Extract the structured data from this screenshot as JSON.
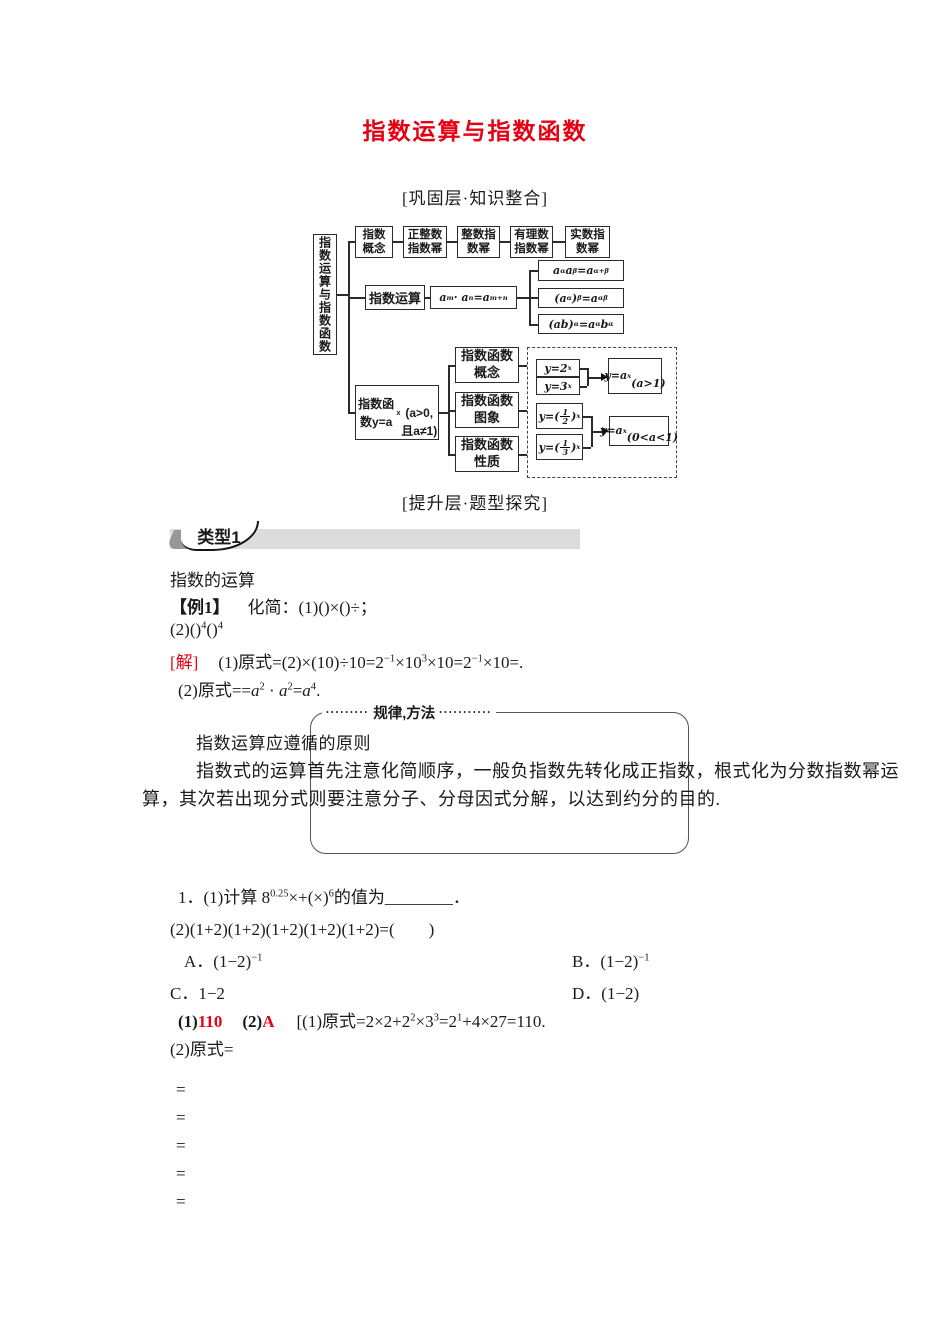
{
  "title": "指数运算与指数函数",
  "sections": {
    "consolidate": "[巩固层·知识整合]",
    "improve": "[提升层·题型探究]"
  },
  "diagram": {
    "root": "指数运算与指数函数",
    "concept_chain": [
      "指数<br>概念",
      "正整数<br>指数幂",
      "整数指<br>数幂",
      "有理数<br>指数幂",
      "实数指<br>数幂"
    ],
    "operation": {
      "label": "指数运算",
      "formula": "a<sup>m</sup> · a<sup>n</sup>=a<sup>m+n</sup>",
      "rules": [
        "a<sup>α</sup>a<sup>β</sup>=a<sup>α+β</sup>",
        "(a<sup>α</sup>)<sup>β</sup>=a<sup>αβ</sup>",
        "(ab)<sup>α</sup>=a<sup>α</sup>b<sup>α</sup>"
      ]
    },
    "function": {
      "label": "指数函数y=a<sup>x</sup><br>(a&gt;0,且a≠1)",
      "children": [
        "指数函数<br>概念",
        "指数函数<br>图象",
        "指数函数<br>性质"
      ],
      "examples_gt1": [
        "y=2<sup>x</sup>",
        "y=3<sup>x</sup>"
      ],
      "result_gt1": "y=a<sup>x</sup><br>(a&gt;1)",
      "examples_lt1": [
        "y=(<span class=fr><i>1</i><i>2</i></span>)<sup>x</sup>",
        "y=(<span class=fr><i>1</i><i>3</i></span>)<sup>x</sup>"
      ],
      "result_lt1": "y=a<sup>x</sup><br>(0&lt;a&lt;1)"
    }
  },
  "type1": {
    "badge": "类型1",
    "subtitle": "指数的运算"
  },
  "example1": {
    "label": "【例1】",
    "intro": "化简：(1)()×()÷；",
    "line2": "(2)()<sup>4</sup>()<sup>4</sup>",
    "solution_label": "[解]",
    "solution1": "(1)原式=(2)×(10)÷10=2<sup>−1</sup>×10<sup>3</sup>×10=2<sup>−1</sup>×10=.",
    "solution2": "(2)原式==<i>a</i><sup>2</sup> · <i>a</i><sup>2</sup>=<i>a</i><sup>4</sup>."
  },
  "method_box": {
    "dots_left": "•••••••••",
    "title": "规律,方法",
    "dots_right": "•••••••••••",
    "heading": "指数运算应遵循的原则",
    "body_line1": "指数式的运算首先注意化简顺序，一般负指数先转化成正指数，根式化为分数指数幂运",
    "body_line2": "算，其次若出现分式则要注意分子、分母因式分解，以达到约分的目的."
  },
  "exercise": {
    "q1": "1．(1)计算 8<sup>0.25</sup>×+(×)<sup>6</sup>的值为________．",
    "q2": "(2)(1+2)(1+2)(1+2)(1+2)(1+2)=(　　)",
    "optionA": "A．(1−2)<sup>−1</sup>",
    "optionB": "B．(1−2)<sup>−1</sup>",
    "optionC": "C．1−2",
    "optionD": "D．(1−2)",
    "answer": {
      "num1": "(1)",
      "ans1": "110",
      "num2": "(2)",
      "ans2": "A",
      "work": "[(1)原式=2×2+2<sup>2</sup>×3<sup>3</sup>=2<sup>1</sup>+4×27=110."
    },
    "work2": "(2)原式=",
    "eq_lines": [
      "=",
      "=",
      "=",
      "=",
      "="
    ]
  },
  "colors": {
    "title_red": "#e60012",
    "bar_gray": "#dcdcdc",
    "badge_dark_gray": "#979797"
  }
}
